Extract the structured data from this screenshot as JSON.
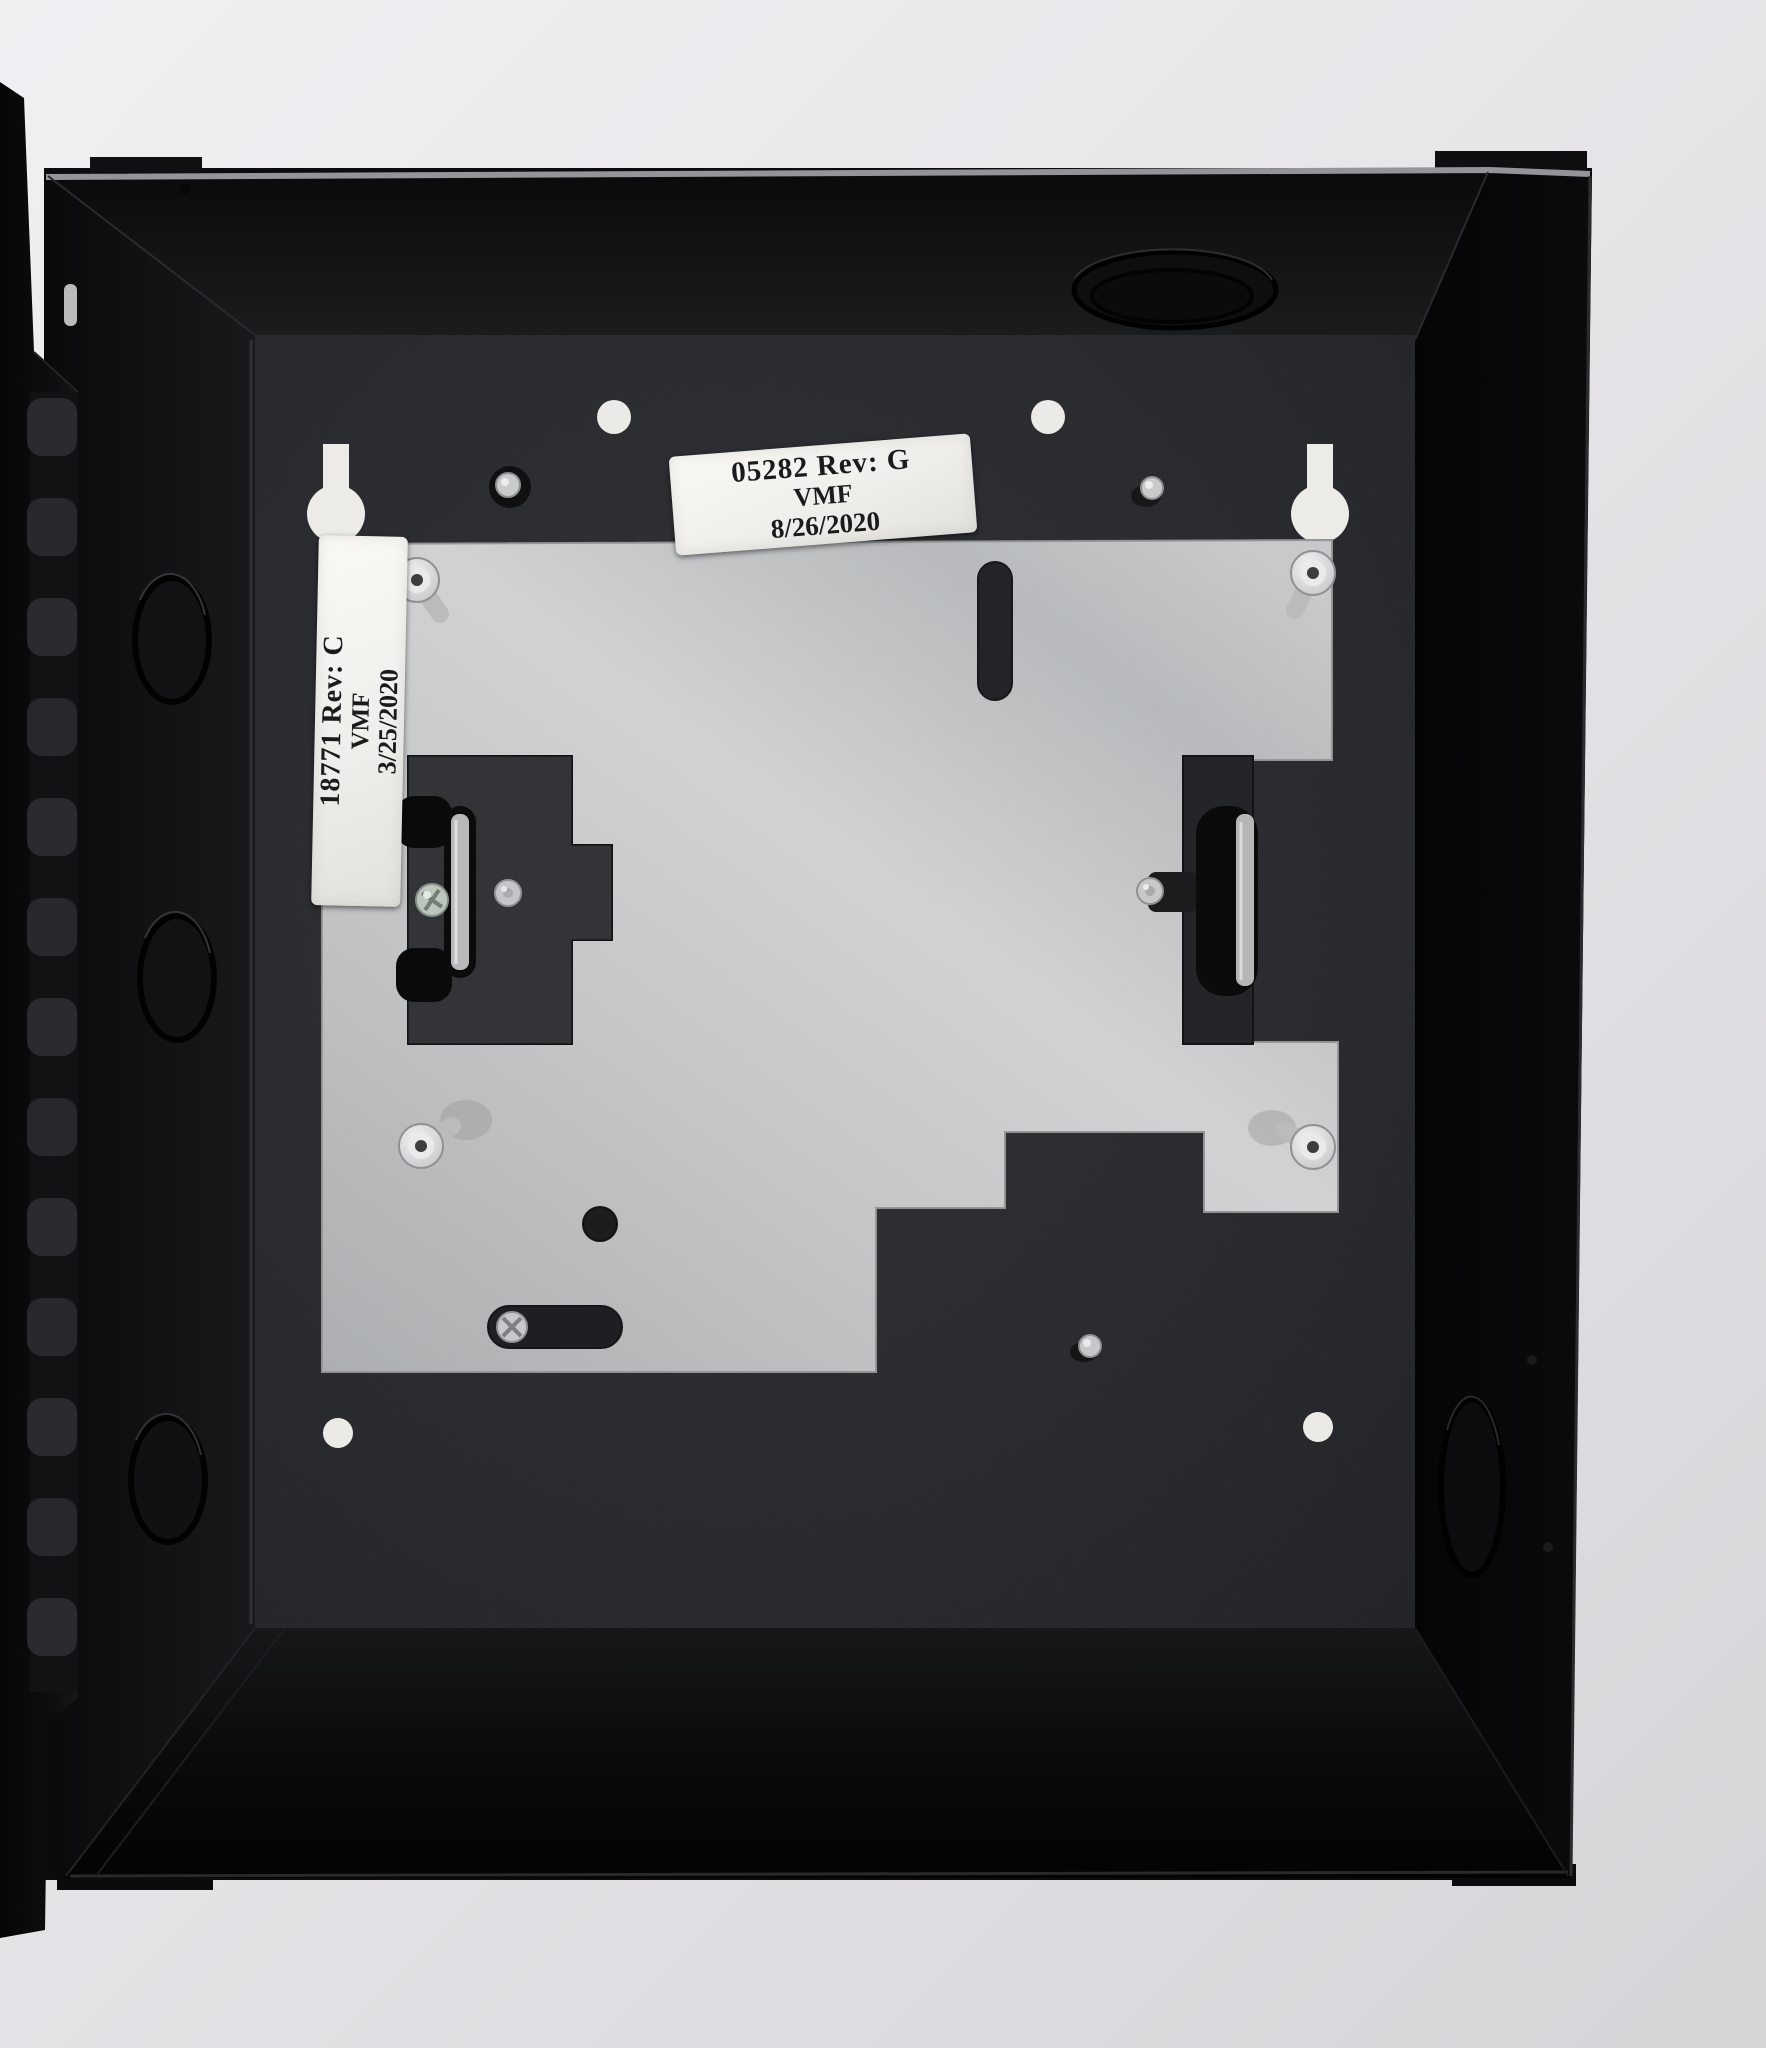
{
  "scene": {
    "subject": "Black sheet-metal security enclosure with open hinged door, galvanized mounting plate and inspection labels",
    "background_color": "#e7e6e9"
  },
  "enclosure": {
    "body_color": "#0d0d0f",
    "back_panel_color": "#232428",
    "door_color": "#101012",
    "plate_color": "#b9bbbd",
    "knockouts_left_wall": 3,
    "knockouts_top_wall": 1,
    "knockouts_right_wall": 1,
    "standoff_studs": 4,
    "keyhole_slots": 2
  },
  "labels": {
    "top": {
      "line1": "05282  Rev: G",
      "line2": "VMF",
      "line3": "8/26/2020"
    },
    "side": {
      "line1": "18771 Rev: C",
      "line2": "VMF",
      "line3": "3/25/2020"
    }
  }
}
